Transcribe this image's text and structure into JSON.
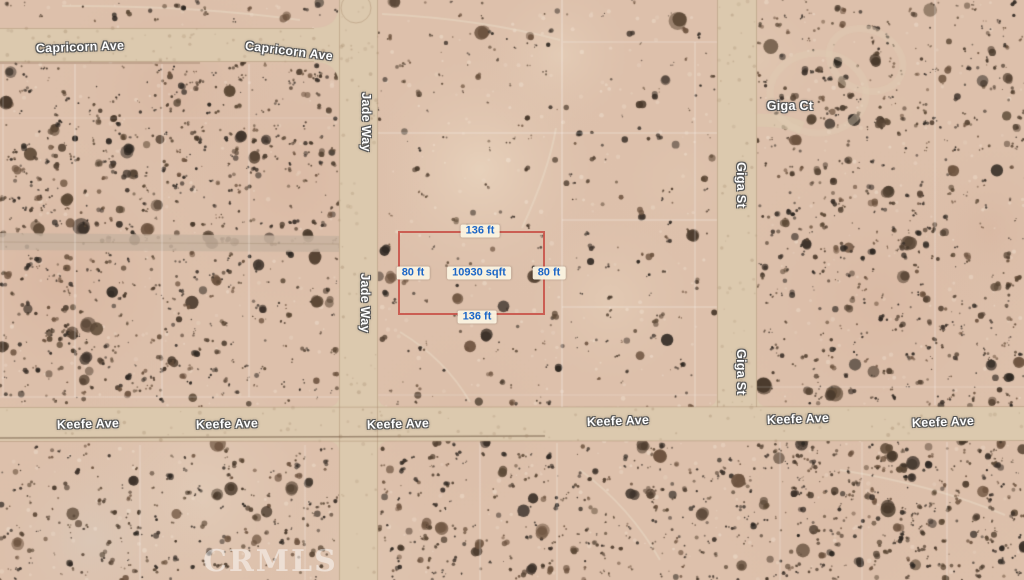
{
  "map_labels": {
    "capricorn_ave_1": "Capricorn Ave",
    "capricorn_ave_2": "Capricorn Ave",
    "jade_way_1": "Jade Way",
    "jade_way_2": "Jade Way",
    "giga_ct": "Giga Ct",
    "giga_st_1": "Giga St",
    "giga_st_2": "Giga St",
    "keefe_ave_1": "Keefe Ave",
    "keefe_ave_2": "Keefe Ave",
    "keefe_ave_3": "Keefe Ave",
    "keefe_ave_4": "Keefe Ave",
    "keefe_ave_5": "Keefe Ave",
    "keefe_ave_6": "Keefe Ave"
  },
  "parcel": {
    "top_dim": "136 ft",
    "bottom_dim": "136 ft",
    "left_dim": "80 ft",
    "right_dim": "80 ft",
    "area": "10930 sqft",
    "outline_color": "rgba(201,83,73,0.9)",
    "label_bg": "rgba(250,243,224,0.96)",
    "label_text_color": "#1b66c7"
  },
  "watermark": "CRMLS",
  "colors": {
    "terrain_base": "#ddc0ab",
    "road_fill": "#dcc9ae",
    "road_edge": "rgba(168,140,110,0.45)",
    "grid_line": "rgba(255,255,255,0.5)",
    "label_halo": "#565656",
    "shrub_palette": [
      "#3d322a",
      "#4a3a2c",
      "#5d4936",
      "#6e5440",
      "#2f2822",
      "#584535"
    ]
  }
}
